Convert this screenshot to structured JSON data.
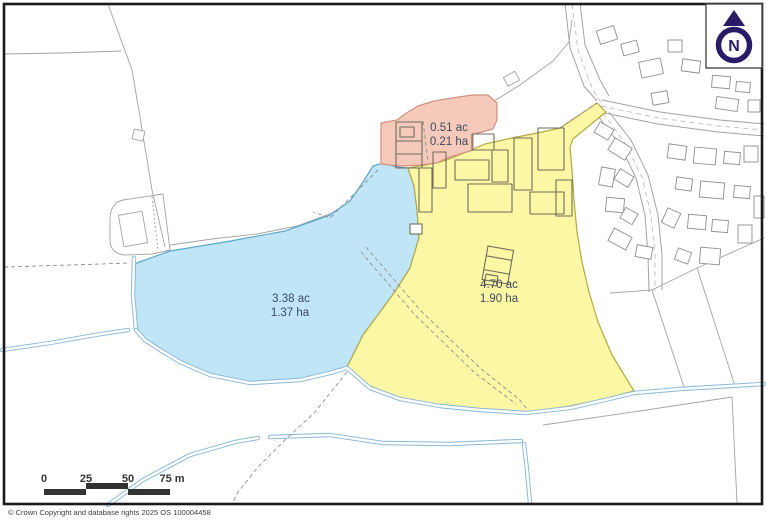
{
  "map": {
    "type": "land-parcel-plan",
    "parcels": [
      {
        "id": "farmhouse-parcel",
        "area_ac": "0.51 ac",
        "area_ha": "0.21 ha"
      },
      {
        "id": "paddock-parcel",
        "area_ac": "3.38 ac",
        "area_ha": "1.37 ha"
      },
      {
        "id": "farmyard-parcel",
        "area_ac": "4.70 ac",
        "area_ha": "1.90 ha"
      }
    ],
    "north_indicator": {
      "label": "N"
    },
    "scale_bar": {
      "ticks": [
        "0",
        "25",
        "50",
        "75 m"
      ]
    },
    "copyright": "© Crown Copyright and database rights 2025 OS 100004458",
    "colors": {
      "pink-fill": "#f5cabb",
      "pink-border": "#d2917e",
      "blue-fill": "#bfe5f6",
      "blue-border": "#5fa8cd",
      "yellow-fill": "#fbf7a5",
      "yellow-border": "#b2a844",
      "water": "#8ab7d7",
      "field-line": "#a3a3a3",
      "building": "#8f8f8f",
      "farm-building": "#6f6e5c",
      "north": "#2a1b66",
      "scale": "#333333",
      "label-text": "#3e4b60",
      "frame": "#1a1a1a"
    }
  }
}
